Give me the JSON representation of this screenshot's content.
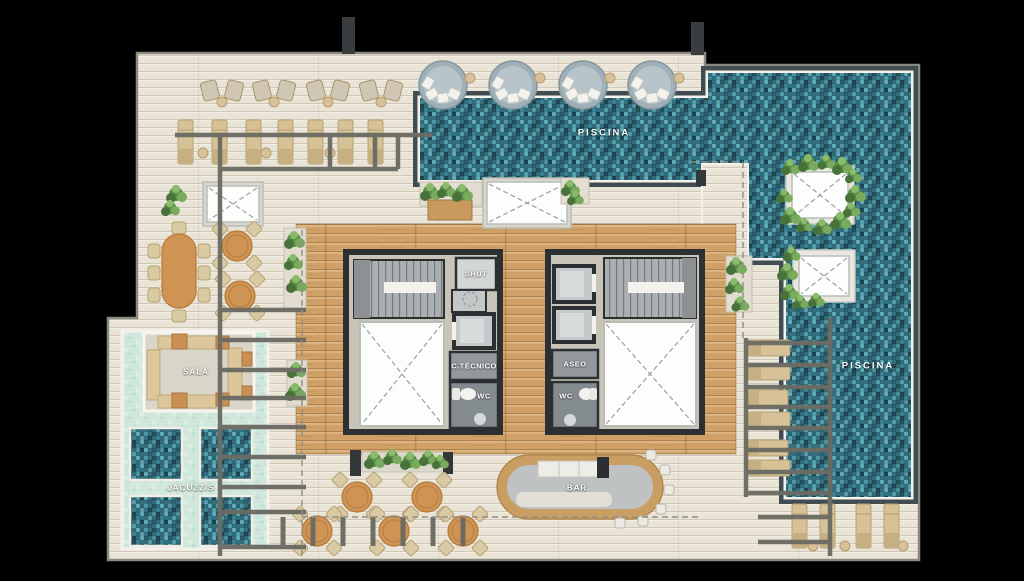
{
  "labels": {
    "pool_top": "PISCINA",
    "pool_right": "PISCINA",
    "sala": "SALA",
    "jacuzzis": "JACUZZIS",
    "bar": "BAR",
    "shut": "SHUT",
    "technical_room": "C.TÉCNICO",
    "aseo": "ASEO",
    "wc_left": "WC",
    "wc_right": "WC"
  },
  "colors": {
    "background": "#000000",
    "deck": "#eae4d7",
    "wood_deck": "#cfa167",
    "pool_tile": "#34707f",
    "shallow_water": "#cde6da",
    "pergola_beam": "#6b6b63",
    "wall": "#2c3033",
    "label_text": "#ffffff"
  }
}
